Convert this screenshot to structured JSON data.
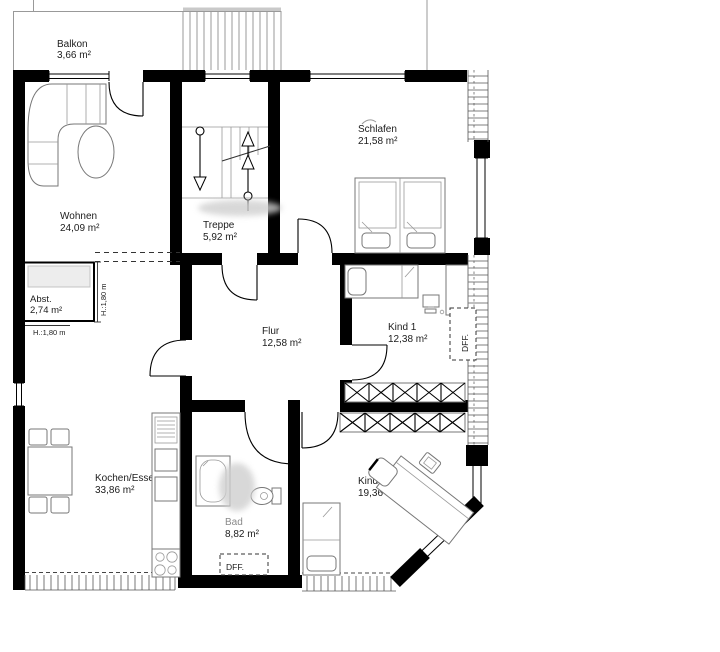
{
  "rooms": {
    "balkon": {
      "name": "Balkon",
      "area": "3,66 m²"
    },
    "wohnen": {
      "name": "Wohnen",
      "area": "24,09 m²"
    },
    "treppe": {
      "name": "Treppe",
      "area": "5,92 m²"
    },
    "schlafen": {
      "name": "Schlafen",
      "area": "21,58 m²"
    },
    "abst": {
      "name": "Abst.",
      "area": "2,74 m²",
      "height_bottom": "H.:1,80 m",
      "height_side": "H.:1,80 m"
    },
    "flur": {
      "name": "Flur",
      "area": "12,58 m²"
    },
    "kind1": {
      "name": "Kind 1",
      "area": "12,38 m²",
      "dff": "DFF."
    },
    "kochen": {
      "name": "Kochen/Essen",
      "area": "33,86 m²"
    },
    "bad": {
      "name": "Bad",
      "area": "8,82 m²",
      "dff": "DFF."
    },
    "kind2": {
      "name": "Kind 2",
      "area": "19,36 m²"
    }
  },
  "colors": {
    "wall": "#000000",
    "furniture": "#777777",
    "background": "#ffffff"
  }
}
